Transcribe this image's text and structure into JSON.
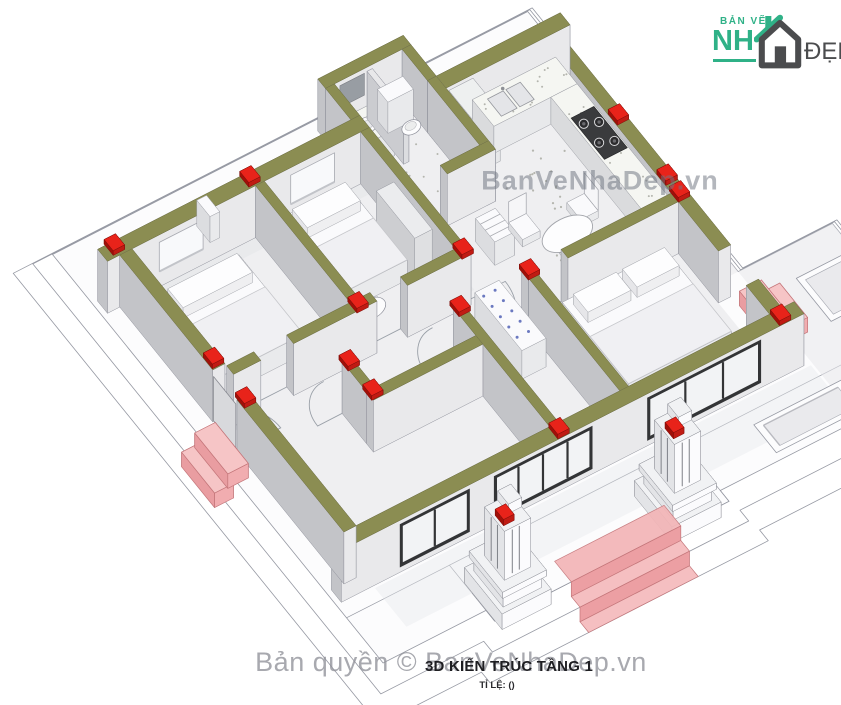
{
  "page": {
    "background": "#ffffff"
  },
  "header_logo": {
    "top_text": "BẢN VẼ",
    "big_text": "NH",
    "suffix_text": "ĐẸP",
    "green": "#2fb187",
    "dark": "#4b4c4e"
  },
  "watermarks": {
    "center": "BanVeNhaDep.vn",
    "copyright": "Bản quyền © BanVeNhaDep.vn"
  },
  "title_block": {
    "title": "3D KIẾN TRÚC TẦNG 1",
    "scale_label": "TỈ LỆ: ()"
  },
  "drawing": {
    "description": "3D axonometric cut-away floor plan of single-storey house",
    "colors": {
      "wallTop": "#8b8d52",
      "wallTopEdge": "#6d6e3e",
      "wallS": "#e9e9eb",
      "wallW": "#c3c4c8",
      "wallN": "#d6d7d9",
      "wallE": "#dfe0e2",
      "floor": "#efeff1",
      "tint": "#e5e6e9",
      "shadow": "#e7e8eb",
      "edge": "#8f919b",
      "base": "#ffffff",
      "baseTop": "#fcfcfd",
      "baseEdge": "#9598a2",
      "red": "#e8231a",
      "redDark": "#c01b13",
      "redDark2": "#a01009",
      "pink": "#f1adb0",
      "pinkTop": "#f6c5c6",
      "pinkSide": "#e99da1",
      "pinkEdge": "#c4767a",
      "arc": "#9aa0a8",
      "mirror": "#989da3",
      "glassFrame": "#333436",
      "glass": "#f2f3f5",
      "speckle": "#b4b5ae",
      "dotBlue": "#6b79c0",
      "white": "#fafafc"
    }
  }
}
